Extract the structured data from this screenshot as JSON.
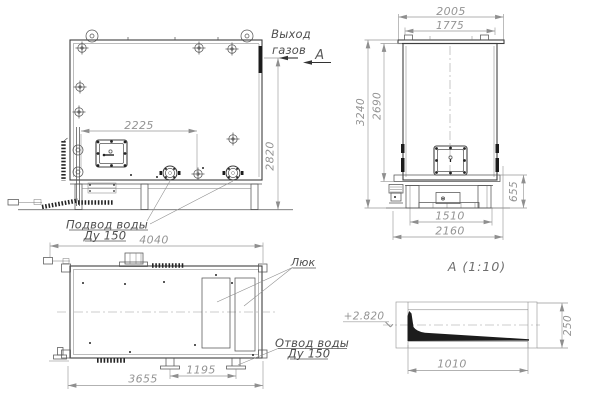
{
  "front_view": {
    "gas_outlet_label_line1": "Выход",
    "gas_outlet_label_line2": "газов",
    "section_cut_label": "А",
    "dim_nozzle_span": "2225",
    "dim_height_to_gas_outlet": "2820",
    "water_inlet_label_line1": "Подвод воды",
    "water_inlet_label_line2": "Ду 150"
  },
  "side_view": {
    "dim_top_overall": "2005",
    "dim_top_inner": "1775",
    "dim_height_overall": "3240",
    "dim_height_shell": "2690",
    "dim_base_height": "655",
    "dim_base_inner_width": "1510",
    "dim_base_overall_width": "2160"
  },
  "plan_view": {
    "dim_length_overall": "4040",
    "dim_length_shell": "3655",
    "dim_nozzle_spacing": "1195",
    "hatch_label": "Люк",
    "water_outlet_label_line1": "Отвод воды",
    "water_outlet_label_line2": "Ду 150"
  },
  "section_a": {
    "title": "А  (1:10)",
    "level_mark": "+2.820",
    "dim_height": "250",
    "dim_length": "1010"
  },
  "colors": {
    "outline": "#3f3f3f",
    "dimension": "#949494",
    "label": "#4f4f4f",
    "fill_black": "#1c1c1c",
    "background": "#ffffff"
  }
}
